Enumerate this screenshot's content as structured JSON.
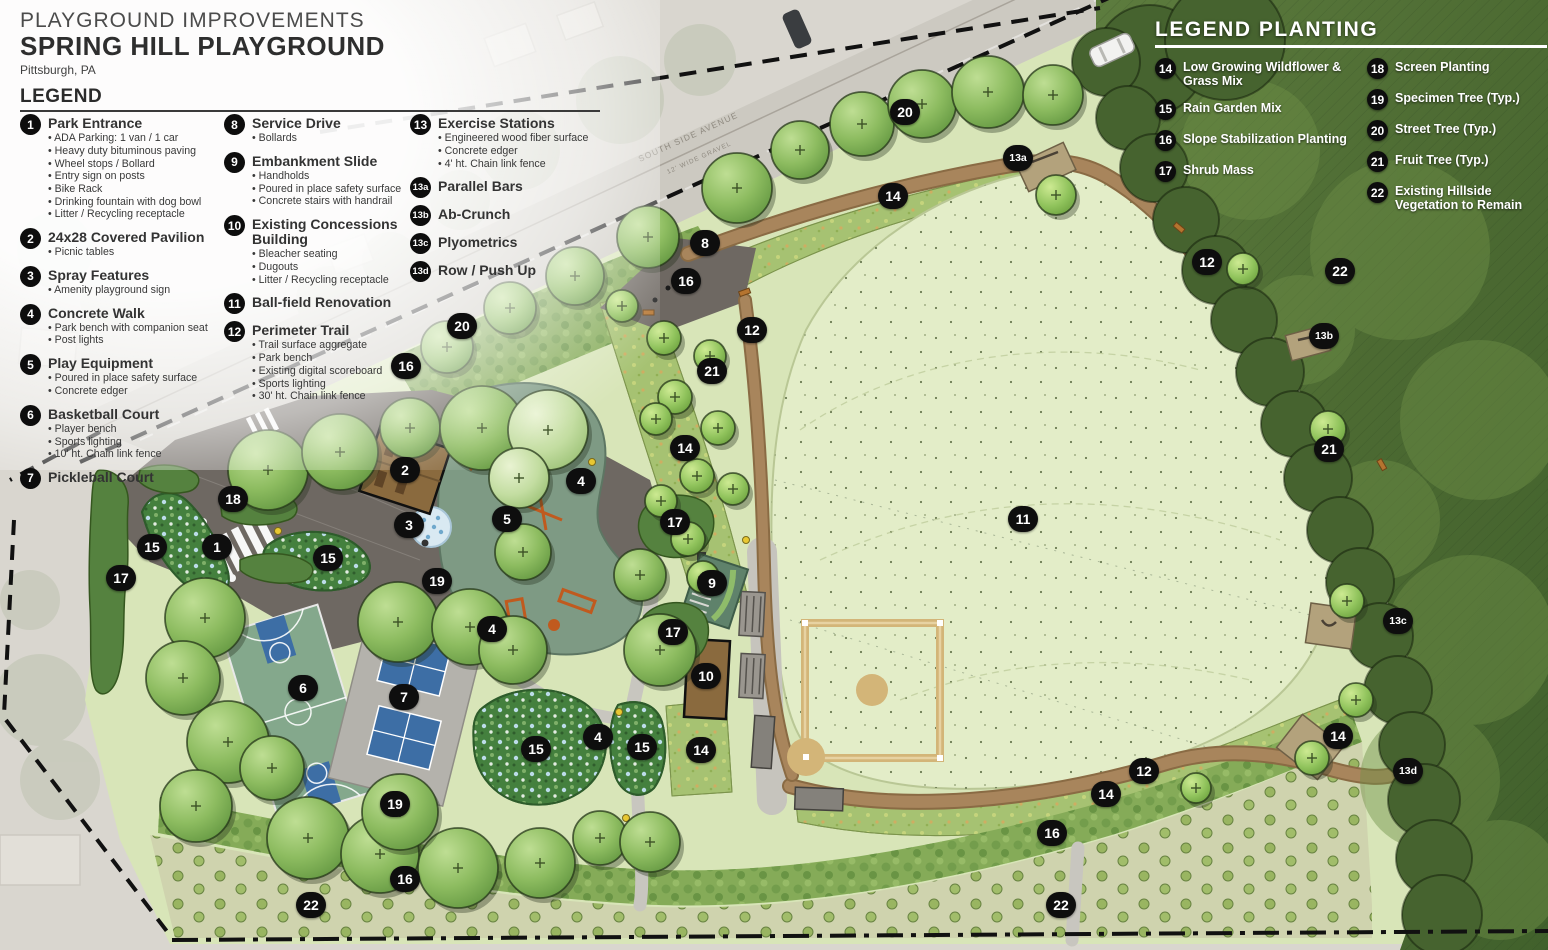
{
  "title_block": {
    "supertitle": "PLAYGROUND IMPROVEMENTS",
    "title": "SPRING HILL PLAYGROUND",
    "subtitle": "Pittsburgh, PA"
  },
  "legend": {
    "heading": "LEGEND",
    "columns": [
      [
        {
          "num": "1",
          "label": "Park Entrance",
          "bullets": [
            "ADA Parking: 1 van / 1 car",
            "Heavy duty bituminous paving",
            "Wheel stops / Bollard",
            "Entry sign on posts",
            "Bike Rack",
            "Drinking fountain with dog bowl",
            "Litter / Recycling receptacle"
          ]
        },
        {
          "num": "2",
          "label": "24x28 Covered Pavilion",
          "bullets": [
            "Picnic tables"
          ]
        },
        {
          "num": "3",
          "label": "Spray Features",
          "bullets": [
            "Amenity playground sign"
          ]
        },
        {
          "num": "4",
          "label": "Concrete Walk",
          "bullets": [
            "Park bench with companion seat",
            "Post lights"
          ]
        },
        {
          "num": "5",
          "label": "Play Equipment",
          "bullets": [
            "Poured in place safety surface",
            "Concrete edger"
          ]
        },
        {
          "num": "6",
          "label": "Basketball Court",
          "bullets": [
            "Player bench",
            "Sports lighting",
            "10' ht. Chain link fence"
          ]
        },
        {
          "num": "7",
          "label": "Pickleball Court",
          "bullets": []
        }
      ],
      [
        {
          "num": "8",
          "label": "Service Drive",
          "bullets": [
            "Bollards"
          ]
        },
        {
          "num": "9",
          "label": "Embankment Slide",
          "bullets": [
            "Handholds",
            "Poured in place safety surface",
            "Concrete stairs with handrail"
          ]
        },
        {
          "num": "10",
          "label": "Existing Concessions Building",
          "bullets": [
            "Bleacher seating",
            "Dugouts",
            "Litter / Recycling receptacle"
          ]
        },
        {
          "num": "11",
          "label": "Ball-field Renovation",
          "bullets": []
        },
        {
          "num": "12",
          "label": "Perimeter Trail",
          "bullets": [
            "Trail surface aggregate",
            "Park bench",
            "Existing digital scoreboard",
            "Sports lighting",
            "30' ht. Chain link fence"
          ]
        }
      ],
      [
        {
          "num": "13",
          "label": "Exercise Stations",
          "bullets": [
            "Engineered wood fiber surface",
            "Concrete edger",
            "4' ht. Chain link fence"
          ]
        },
        {
          "num": "13a",
          "label": "Parallel Bars",
          "bullets": []
        },
        {
          "num": "13b",
          "label": "Ab-Crunch",
          "bullets": []
        },
        {
          "num": "13c",
          "label": "Plyometrics",
          "bullets": []
        },
        {
          "num": "13d",
          "label": "Row / Push Up",
          "bullets": []
        }
      ]
    ]
  },
  "planting_legend": {
    "heading": "LEGEND PLANTING",
    "columns": [
      [
        {
          "num": "14",
          "label": "Low Growing Wildflower & Grass Mix"
        },
        {
          "num": "15",
          "label": "Rain Garden Mix"
        },
        {
          "num": "16",
          "label": "Slope Stabilization Planting"
        },
        {
          "num": "17",
          "label": "Shrub Mass"
        }
      ],
      [
        {
          "num": "18",
          "label": "Screen Planting"
        },
        {
          "num": "19",
          "label": "Specimen Tree (Typ.)"
        },
        {
          "num": "20",
          "label": "Street Tree (Typ.)"
        },
        {
          "num": "21",
          "label": "Fruit Tree (Typ.)"
        },
        {
          "num": "22",
          "label": "Existing Hillside Vegetation to Remain"
        }
      ]
    ]
  },
  "map": {
    "road_label": "SOUTH SIDE AVENUE",
    "road_sublabel": "12' WIDE GRAVEL",
    "markers": [
      {
        "n": "20",
        "x": 905,
        "y": 112
      },
      {
        "n": "13a",
        "x": 1018,
        "y": 158
      },
      {
        "n": "14",
        "x": 893,
        "y": 196
      },
      {
        "n": "8",
        "x": 705,
        "y": 243
      },
      {
        "n": "12",
        "x": 1207,
        "y": 262
      },
      {
        "n": "22",
        "x": 1340,
        "y": 271
      },
      {
        "n": "16",
        "x": 686,
        "y": 281
      },
      {
        "n": "20",
        "x": 462,
        "y": 326
      },
      {
        "n": "12",
        "x": 752,
        "y": 330
      },
      {
        "n": "13b",
        "x": 1324,
        "y": 336
      },
      {
        "n": "16",
        "x": 406,
        "y": 366
      },
      {
        "n": "21",
        "x": 712,
        "y": 371
      },
      {
        "n": "14",
        "x": 685,
        "y": 448
      },
      {
        "n": "21",
        "x": 1329,
        "y": 449
      },
      {
        "n": "2",
        "x": 405,
        "y": 470
      },
      {
        "n": "4",
        "x": 581,
        "y": 481
      },
      {
        "n": "18",
        "x": 233,
        "y": 499
      },
      {
        "n": "5",
        "x": 507,
        "y": 519
      },
      {
        "n": "11",
        "x": 1023,
        "y": 519
      },
      {
        "n": "17",
        "x": 675,
        "y": 522
      },
      {
        "n": "3",
        "x": 409,
        "y": 525
      },
      {
        "n": "1",
        "x": 217,
        "y": 547
      },
      {
        "n": "15",
        "x": 152,
        "y": 547
      },
      {
        "n": "15",
        "x": 328,
        "y": 558
      },
      {
        "n": "17",
        "x": 121,
        "y": 578
      },
      {
        "n": "19",
        "x": 437,
        "y": 581
      },
      {
        "n": "9",
        "x": 712,
        "y": 583
      },
      {
        "n": "13c",
        "x": 1398,
        "y": 621
      },
      {
        "n": "4",
        "x": 492,
        "y": 629
      },
      {
        "n": "17",
        "x": 673,
        "y": 632
      },
      {
        "n": "10",
        "x": 706,
        "y": 676
      },
      {
        "n": "6",
        "x": 303,
        "y": 688
      },
      {
        "n": "7",
        "x": 404,
        "y": 697
      },
      {
        "n": "14",
        "x": 1338,
        "y": 736
      },
      {
        "n": "4",
        "x": 598,
        "y": 737
      },
      {
        "n": "15",
        "x": 536,
        "y": 749
      },
      {
        "n": "15",
        "x": 642,
        "y": 747
      },
      {
        "n": "14",
        "x": 701,
        "y": 750
      },
      {
        "n": "12",
        "x": 1144,
        "y": 771
      },
      {
        "n": "13d",
        "x": 1408,
        "y": 771
      },
      {
        "n": "14",
        "x": 1106,
        "y": 794
      },
      {
        "n": "19",
        "x": 395,
        "y": 804
      },
      {
        "n": "16",
        "x": 1052,
        "y": 833
      },
      {
        "n": "16",
        "x": 405,
        "y": 879
      },
      {
        "n": "22",
        "x": 311,
        "y": 905
      },
      {
        "n": "22",
        "x": 1061,
        "y": 905
      }
    ]
  },
  "colors": {
    "marker_bg": "#0e0e0e",
    "marker_text": "#ffffff",
    "trail_brown": "#a8855c",
    "park_green": "#d8e5b8",
    "field_green": "#e3edc8",
    "forest_green": "#4e6b33",
    "court_blue": "#3d6ea5",
    "court_green": "#84a88c",
    "asphalt_gray": "#6e6862",
    "pavilion_brown": "#8a6a3e",
    "infield_tan": "#d3b578",
    "rain_garden_green": "#44803e",
    "wildflower_green": "#a6c272",
    "slope_green": "#85ab58",
    "hillside_tan": "#cfd3ae"
  }
}
